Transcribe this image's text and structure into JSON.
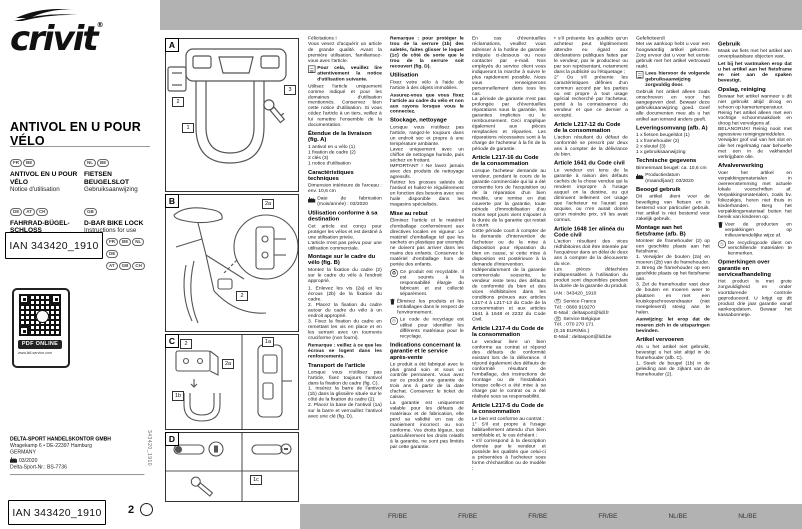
{
  "cover": {
    "brand": "crivit",
    "title": "ANTIVOL EN U POUR VÉLO",
    "lang_blocks": [
      {
        "pills": [
          "FR",
          "BE"
        ],
        "name": "ANTIVOL EN U POUR VÉLO",
        "sub": "Notice d'utilisation"
      },
      {
        "pills": [
          "NL",
          "BE"
        ],
        "name": "FIETSEN BEUGELSLOT",
        "sub": "Gebruiksaanwijzing"
      },
      {
        "pills": [
          "DE",
          "AT",
          "CH"
        ],
        "name": "FAHRRAD-BÜGEL-SCHLOSS",
        "sub": "Gebrauchsanweisung"
      },
      {
        "pills": [
          "GB"
        ],
        "name": "D-BAR BIKE LOCK",
        "sub": "Instructions for use"
      }
    ],
    "ian": "IAN 343420_1910",
    "ian_flags": [
      [
        "FR",
        "BE",
        "NL",
        "DE"
      ],
      [
        "AT",
        "GB",
        "CH"
      ]
    ],
    "qr_label": "PDF ONLINE",
    "qr_url": "www.lidl-service.com",
    "company": {
      "name": "DELTA-SPORT HANDELSKONTOR GMBH",
      "street": "Wragekamp 6 • DE-22397 Hamburg",
      "country": "GERMANY",
      "date": "03/2020",
      "ref": "Delta-Sport-Nr.: BS-7736"
    },
    "side_code": "343420_1910",
    "page_number": "2"
  },
  "diagrams": {
    "panels": [
      {
        "id": "A",
        "chips": [
          "2",
          "1",
          "3"
        ]
      },
      {
        "id": "B",
        "chips": [
          "2a",
          "2"
        ]
      },
      {
        "id": "C",
        "chips": [
          "2",
          "2a",
          "1b",
          "1a"
        ]
      },
      {
        "id": "D",
        "chips": [
          "1c"
        ]
      }
    ]
  },
  "columns": [
    {
      "blocks": [
        {
          "t": "p",
          "x": "Félicitations !\nVous venez d'acquérir un article de grande qualité. Avant la première utilisation, familiarisez-vous avec l'article."
        },
        {
          "t": "ic",
          "icon": "book",
          "b": true,
          "x": "Pour cela, veuillez lire attentivement la notice d'utilisation suivante."
        },
        {
          "t": "p",
          "x": "Utilisez l'article uniquement comme indiqué et pour les domaines d'utilisation mentionnés. Conservez bien cette notice d'utilisation. Si vous cédez l'article à un tiers, veillez à lui remettre l'ensemble de la documentation."
        },
        {
          "t": "h",
          "x": "Étendue de la livraison (fig. A)"
        },
        {
          "t": "pt",
          "x": "1 antivol en u vélo (1)\n1 fixation de cadre (2)\n2 clés (3)\n1 notice d'utilisation"
        },
        {
          "t": "h",
          "x": "Caractéristiques techniques"
        },
        {
          "t": "p",
          "x": "Dimension intérieure de l'arceau : env. 10,6 cm"
        },
        {
          "t": "ic",
          "icon": "factory",
          "x": "Date de fabrication (mois/année) : 03/2020"
        },
        {
          "t": "h",
          "x": "Utilisation conforme à sa destination"
        },
        {
          "t": "p",
          "x": "Cet article est conçu pour protéger les vélos et est destiné à une utilisation privée.\nL'article n'est pas prévu pour une utilisation commerciale."
        },
        {
          "t": "h",
          "x": "Montage sur le cadre du vélo (fig. B)"
        },
        {
          "t": "p",
          "x": "Montez la fixation du cadre (2) sur le cadre du vélo à l'endroit approprié."
        },
        {
          "t": "p",
          "x": "1. Enlevez les vis (2a) et les écrous (2b) de la fixation du cadre.\n2. Placez la fixation du cadre autour du cadre du vélo à un endroit approprié.\n3. Fixez la fixation du cadre en remettant les vis en place et en les serrant avec un tournevis cruciforme (non fourni)."
        },
        {
          "t": "pb",
          "x": "Remarque : veillez à ce que les écrous se logent dans les renfoncements."
        },
        {
          "t": "h",
          "x": "Transport de l'article"
        },
        {
          "t": "p",
          "x": "Lorsque vous n'utilisez pas l'article, fixez toujours l'antivol dans la fixation du cadre (fig. C).\n1. Insérez la barre de l'antivol (1b) dans la glissière située sur le côté de la fixation du cadre (2).\n2. Placez la base de l'antivol (1a) sur la barre et verrouillez l'antivol avec une clé (fig. D)."
        }
      ]
    },
    {
      "blocks": [
        {
          "t": "pb",
          "x": "Remarque : pour protéger le trou de la serrure (1b) des saletés, faites glisser le loquet (1c) de côté de sorte que le trou de la serrure soit recouvert (fig. D)."
        },
        {
          "t": "h",
          "x": "Utilisation"
        },
        {
          "t": "p",
          "x": "Fixez votre vélo à l'aide de l'article à des objets immobiles."
        },
        {
          "t": "pb",
          "x": "Assurez-vous que vous fixez l'article au cadre du vélo et non aux rayons lorsque vous le connectez."
        },
        {
          "t": "h",
          "x": "Stockage, nettoyage"
        },
        {
          "t": "p",
          "x": "Lorsque vous n'utilisez pas l'article, rangez-le toujours dans un endroit sec et propre à une température ambiante.\nLavez uniquement avec un chiffon de nettoyage humide, puis séchez en frottant.\nIMPORTANT ! Ne lavez jamais avec des produits de nettoyage agressifs.\nRetirez les grosses saletés de l'antivol et huilez-le régulièrement en fonction des besoins avec une huile disponible dans les magasins spécialisés."
        },
        {
          "t": "h",
          "x": "Mise au rebut"
        },
        {
          "t": "p",
          "x": "Éliminez l'article et le matériel d'emballage conformément aux directives locales en vigueur. Le matériel d'emballage tel que les sachets en plastique par exemple ne doivent pas arriver dans les mains des enfants. Conservez le matériel d'emballage hors de portée des enfants."
        },
        {
          "t": "ic",
          "icon": "circ-recycle",
          "x": "Ce produit est recyclable. Il est soumis à la responsabilité élargie du fabricant et est collecté séparément."
        },
        {
          "t": "ic",
          "icon": "trash",
          "x": "Éliminez les produits et les emballages dans le respect de l'environnement."
        },
        {
          "t": "ic",
          "icon": "tri-recycle",
          "x": "Le code de recyclage est utilisé pour identifier les différents matériaux pour le recyclage."
        },
        {
          "t": "h",
          "x": "Indications concernant la garantie et le service après-vente"
        },
        {
          "t": "p",
          "x": "Le produit a été fabriqué avec le plus grand soin et sous un contrôle permanent. Vous avez sur ce produit une garantie de trois ans à partir de la date d'achat. Conservez le ticket de caisse.\nLa garantie est uniquement valable pour les défauts de matériaux et de fabrication, elle perd sa validité en cas de maniement incorrect ou non conforme. Vos droits légaux, tout particulièrement les droits relatifs à la garantie, ne sont pas limités par cette garantie."
        }
      ]
    },
    {
      "blocks": [
        {
          "t": "p",
          "x": "En cas d'éventuelles réclamations, veuillez vous adresser à la hotline de garantie indiquée ci-dessous ou nous contacter par e-mail. Nos employés du service client vous indiqueront la marche à suivre le plus rapidement possible. Nous vous renseignerons personnellement dans tous les cas.\nLa période de garantie n'est pas prolongée par d'éventuelles réparations sous la garantie, les garanties implicites ou le remboursement. Ceci s'applique également aux pièces remplacées et réparées. Les réparations nécessaires sont à la charge de l'acheteur à la fin de la période de garantie."
        },
        {
          "t": "h",
          "x": "Article L217-16 du Code de la consommation"
        },
        {
          "t": "p",
          "x": "Lorsque l'acheteur demande au vendeur, pendant le cours de la garantie commerciale qui lui a été consentie lors de l'acquisition ou de la réparation d'un bien meuble, une remise en état couverte par la garantie, toute période d'immobilisation d'au moins sept jours vient s'ajouter à la durée de la garantie qui restait à courir.\nCette période court à compter de la demande d'intervention de l'acheteur ou de la mise à disposition pour réparation du bien en cause, si cette mise à disposition est postérieure à la demande d'intervention.\nIndépendamment de la garantie commerciale souscrite, le vendeur reste tenu des défauts de conformité du bien et des vices rédhibitoires dans les conditions prévues aux articles L217-4 à L217-13 du Code de la consommation et aux articles 1641 à 1648 et 2232 du Code Civil."
        },
        {
          "t": "h",
          "x": "Article L217-4 du Code de la consommation"
        },
        {
          "t": "p",
          "x": "Le vendeur livre un bien conforme au contrat et répond des défauts de conformité existant lors de la délivrance. Il répond également des défauts de conformité résultant de l'emballage, des instructions de montage ou de l'installation lorsque celle-ci a été mise à sa charge par le contrat ou a été réalisée sous sa responsabilité."
        },
        {
          "t": "h",
          "x": "Article L217-5 du Code de la consommation"
        },
        {
          "t": "p",
          "x": "Le bien est conforme au contrat :\n1° S'il est propre à l'usage habituellement attendu d'un bien semblable et, le cas échéant :\n• s'il correspond à la description donnée par le vendeur et possède les qualités que celui-ci a présentées à l'acheteur sous forme d'échantillon ou de modèle ;"
        }
      ]
    },
    {
      "blocks": [
        {
          "t": "p",
          "x": "• s'il présente les qualités qu'un acheteur peut légitimement attendre eu égard aux déclarations publiques faites par le vendeur, par le producteur ou par son représentant, notamment dans la publicité ou l'étiquetage ;\n2° Ou s'il présente les caractéristiques définies d'un commun accord par les parties ou est propre à tout usage spécial recherché par l'acheteur, porté à la connaissance du vendeur et que ce dernier a accepté."
        },
        {
          "t": "h",
          "x": "Article L217-12 du Code de la consommation"
        },
        {
          "t": "p",
          "x": "L'action résultant du défaut de conformité se prescrit par deux ans à compter de la délivrance du bien."
        },
        {
          "t": "h",
          "x": "Article 1641 du Code civil"
        },
        {
          "t": "p",
          "x": "Le vendeur est tenu de la garantie à raison des défauts cachés de la chose vendue qui la rendent impropre à l'usage auquel on la destine, ou qui diminuent tellement cet usage que l'acheteur ne l'aurait pas acquise, ou n'en aurait donné qu'un moindre prix, s'il les avait connus."
        },
        {
          "t": "h",
          "x": "Article 1648 1er alinéa du Code civil"
        },
        {
          "t": "p",
          "x": "L'action résultant des vices rédhibitoires doit être intentée par l'acquéreur dans un délai de deux ans à compter de la découverte du vice.\nLes pièces détachées indispensables à l'utilisation du produit sont disponibles pendant la durée de la garantie du produit."
        },
        {
          "t": "p",
          "x": "IAN : 343420_1910"
        },
        {
          "t": "svc",
          "lines": [
            {
              "pill": "FR",
              "x": "Service France"
            },
            {
              "x": "Tél. : 0800 919270"
            },
            {
              "x": "E-Mail : deltasport@lidl.fr"
            },
            {
              "pill": "BE",
              "x": "Service Belgique"
            },
            {
              "x": "Tél. : 070 270 171"
            },
            {
              "x": "(0,15 EUR/Min.)"
            },
            {
              "x": "E-Mail : deltasport@lidl.be"
            }
          ]
        }
      ]
    },
    {
      "blocks": [
        {
          "t": "p",
          "x": "Gefeliciteerd!\nMet uw aankoop hebt u voor een hoogwaardig artikel gekozen. Zorg ervoor dat u voor het eerste gebruik met het artikel vertrouwd raakt."
        },
        {
          "t": "ic",
          "icon": "book",
          "b": true,
          "x": "Lees hiervoor de volgende gebruiksaanwijzing zorgvuldig door."
        },
        {
          "t": "p",
          "x": "Gebruik het artikel alleen zoals omschreven en voor het aangegeven doel. Bewaar deze gebruiksaanwijzing goed. Geef alle documenten mee als u het artikel aan iemand anders geeft."
        },
        {
          "t": "h",
          "x": "Leveringsomvang (afb. A)"
        },
        {
          "t": "pt",
          "x": "1 x fietsen beugelslot (1)\n1 x framehouder (2)\n2 x sleutel (3)\n1 x gebruiksaanwijzing"
        },
        {
          "t": "h",
          "x": "Technische gegevens"
        },
        {
          "t": "p",
          "x": "Binnenmaat beugel: ca. 10,6 cm"
        },
        {
          "t": "ic",
          "icon": "factory",
          "x": "Productiedatum (maand/jaar): 03/2020"
        },
        {
          "t": "h",
          "x": "Beoogd gebruik"
        },
        {
          "t": "p",
          "x": "Dit artikel dient voor de beveiliging van fietsen en is bestemd voor particulier gebruik. Het artikel is niet bestemd voor zakelijk gebruik."
        },
        {
          "t": "h",
          "x": "Montage aan het fietsframe (afb. B)"
        },
        {
          "t": "p",
          "x": "Monteer de framehouder (2) op een geschikte plaats aan het fietsframe.\n1. Verwijder de bouten (2a) en moeren (2b) van de framehouder.\n2. Breng de framehouder op een geschikte plaats op het fietsframe aan.\n3. Zet de framehouder vast door de bouten en moeren weer te plaatsen en met een kruiskopschroevendraaier (niet meegeleverd) stevig aan te halen."
        },
        {
          "t": "pb",
          "x": "Aanwijzing: let erop dat de moeren zich in de uitsparingen bevinden."
        },
        {
          "t": "h",
          "x": "Artikel vervoeren"
        },
        {
          "t": "p",
          "x": "Als u het artikel niet gebruikt, bevestigt u het slot altijd in de framehouder (afb. C).\n1. Steek de beugel (1b) in de geleiding aan de zijkant van de framehouder (2)."
        }
      ]
    },
    {
      "blocks": [
        {
          "t": "h",
          "x": "Gebruik"
        },
        {
          "t": "p",
          "x": "Maak uw fiets met het artikel aan onverplaatsbare objecten vast."
        },
        {
          "t": "pb",
          "x": "Let bij het vastmaken erop dat u het artikel aan het fietsframe en niet aan de spaken bevestigt."
        },
        {
          "t": "h",
          "x": "Opslag, reiniging"
        },
        {
          "t": "p",
          "x": "Bewaar het artikel wanneer u dit niet gebruikt altijd droog en schoon op kamertemperatuur.\nReinig het artikel alleen met een vochtige schoonmaakdoek en droog het vervolgens af.\nBELANGRIJK! Reinig nooit met agressieve reinigingsmiddelen.\nVerwijder grof vuil van het slot en olie het regelmatig naar behoefte met een in de vakhandel verkrijgbare olie."
        },
        {
          "t": "h",
          "x": "Afvalverwerking"
        },
        {
          "t": "p",
          "x": "Voer het artikel en verpakkingsmaterialen in overeenstemming met actuele lokale voorschriften af. Verpakkingsmaterialen, zoals bv. foliezakjes, horen niet thuis in kinderhanden. Berg het verpakkingsmateriaal buiten het bereik van kinderen op."
        },
        {
          "t": "ic",
          "icon": "trash",
          "x": "Voer de producten en verpakkingen op milieuvriendelijke wijze af."
        },
        {
          "t": "ic",
          "icon": "tri-recycle",
          "x": "De recyclingcode dient om verschillende materialen te kenmerken."
        },
        {
          "t": "h",
          "x": "Opmerkingen over garantie en serviceafhandeling"
        },
        {
          "t": "p",
          "x": "Het product is met grote zorgvuldigheid en onder voortdurende controle geproduceerd. U krijgt op dit product drie jaar garantie vanaf aankoopdatum. Bewaar het kassabonnetje."
        }
      ]
    }
  ],
  "footer": {
    "region_labels": [
      "FR/BE",
      "FR/BE",
      "FR/BE",
      "FR/BE",
      "NL/BE",
      "NL/BE"
    ]
  },
  "colors": {
    "band_gray": "#b2b2b2",
    "ink": "#111111"
  }
}
